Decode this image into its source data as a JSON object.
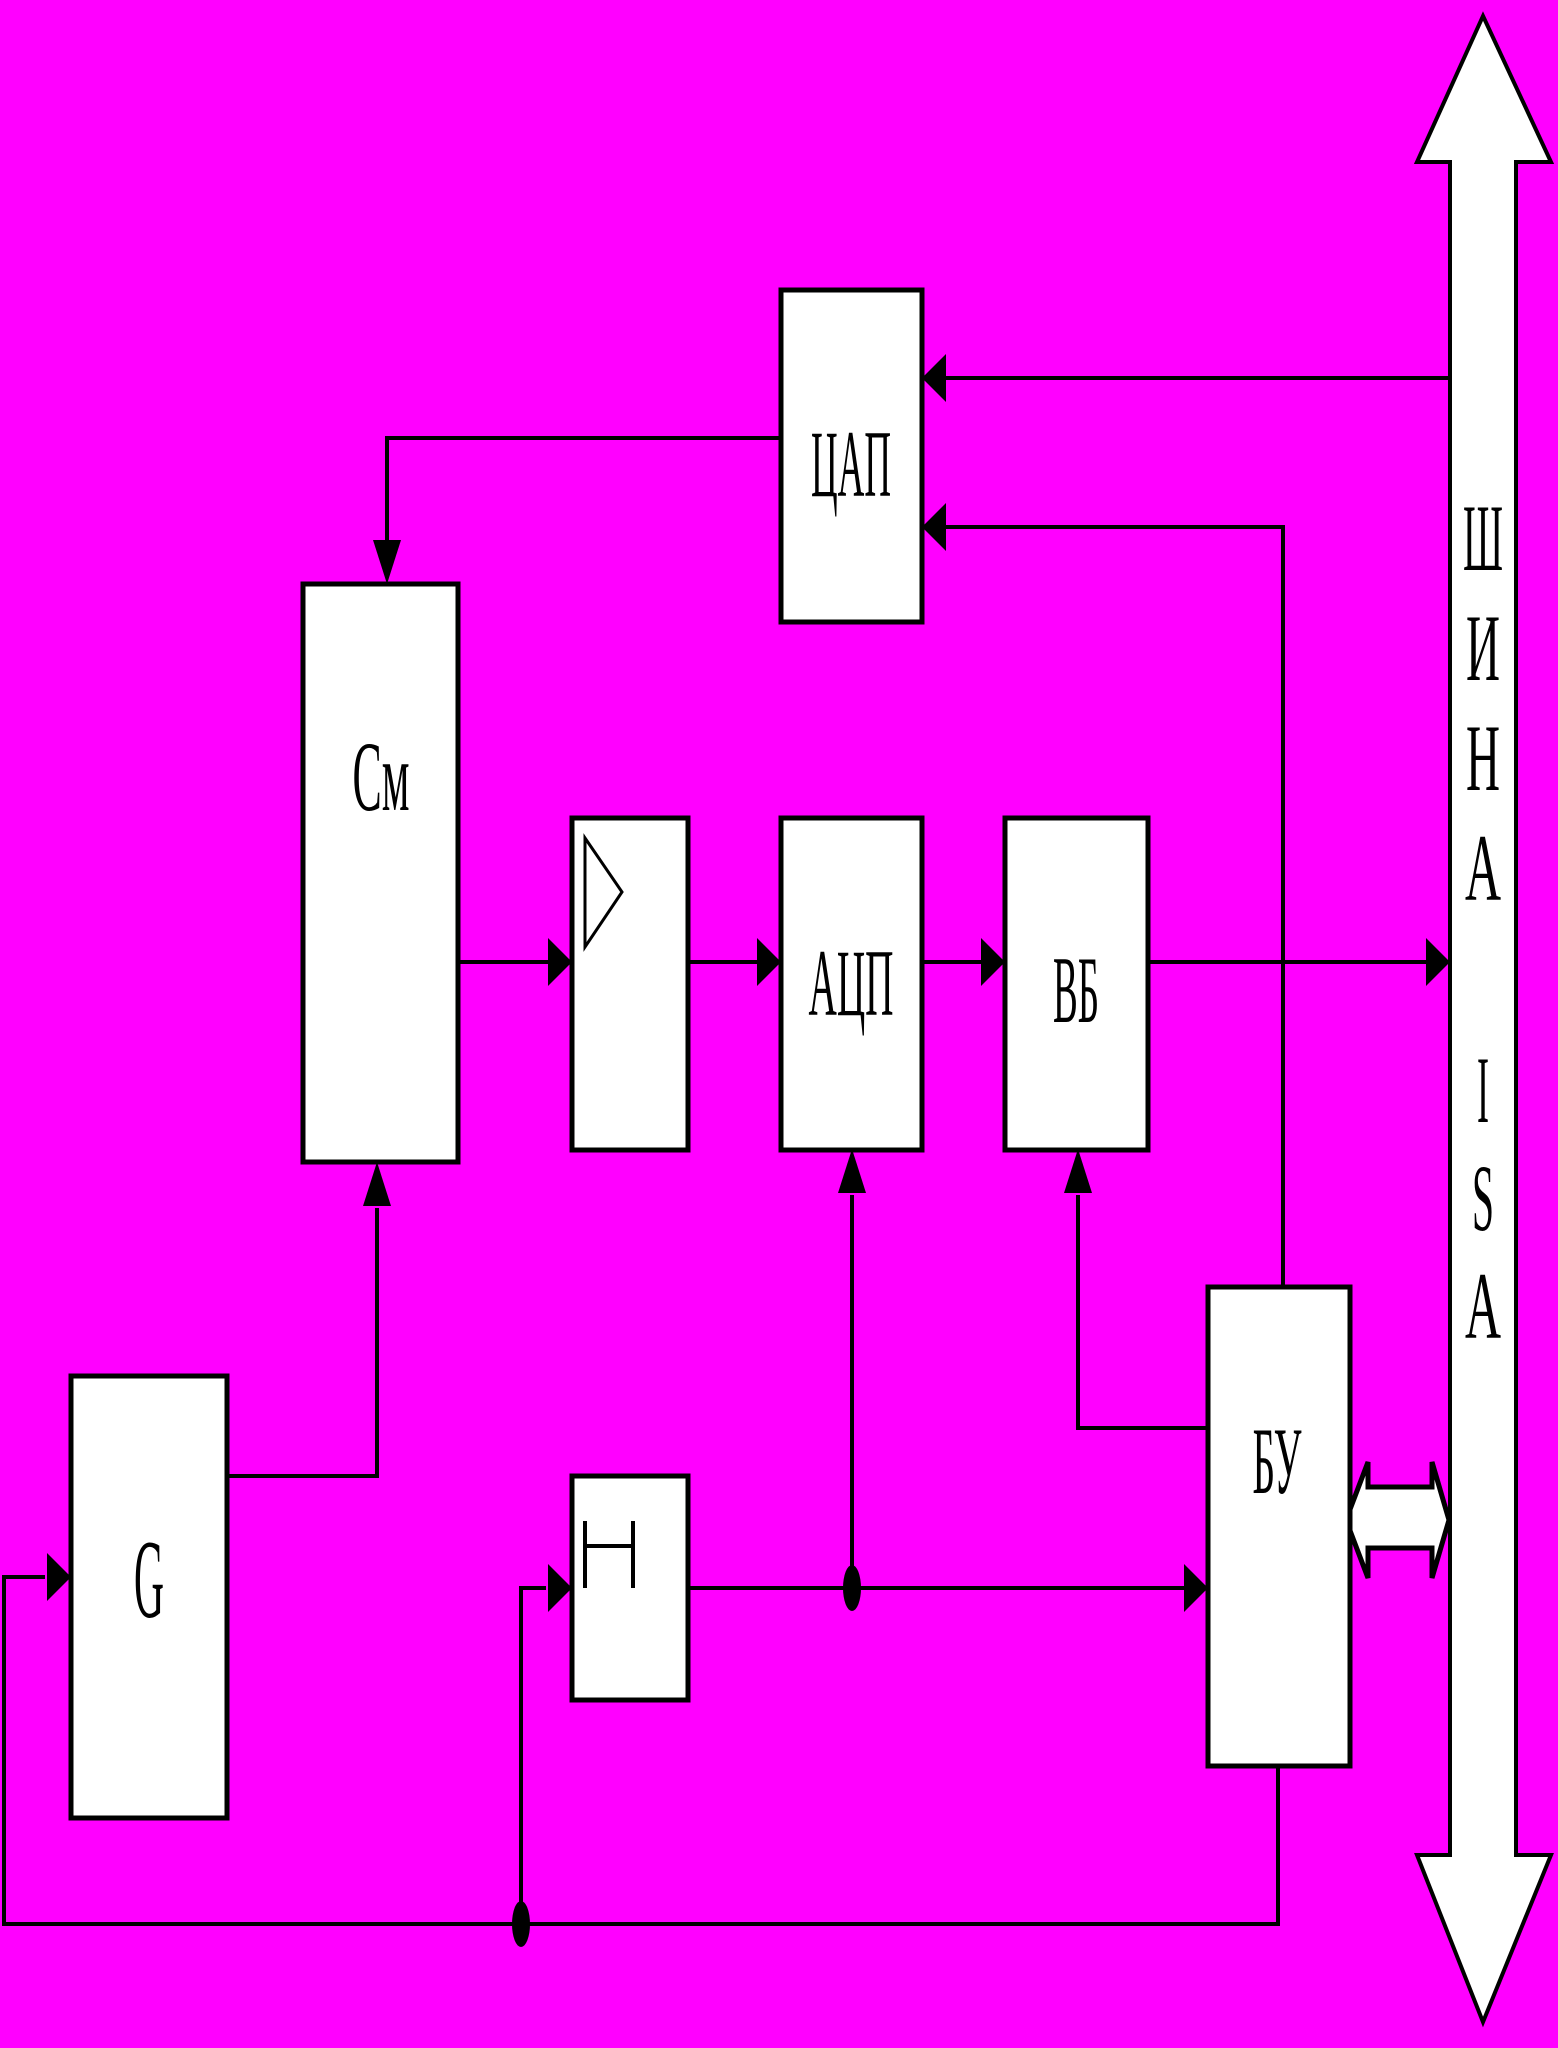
{
  "colors": {
    "background": "#FF00FF",
    "shape_fill": "#FFFFFF",
    "line": "#000000"
  },
  "blocks": {
    "dac": {
      "label": "ЦАП"
    },
    "mixer": {
      "label": "См"
    },
    "adc": {
      "label": "АЦП"
    },
    "output_buffer": {
      "label": "ВБ"
    },
    "control_unit": {
      "label": "БУ"
    },
    "generator": {
      "label": "G"
    }
  },
  "bus": {
    "name_letters": [
      "Ш",
      "И",
      "Н",
      "А"
    ],
    "standard_letters": [
      "I",
      "S",
      "A"
    ]
  }
}
